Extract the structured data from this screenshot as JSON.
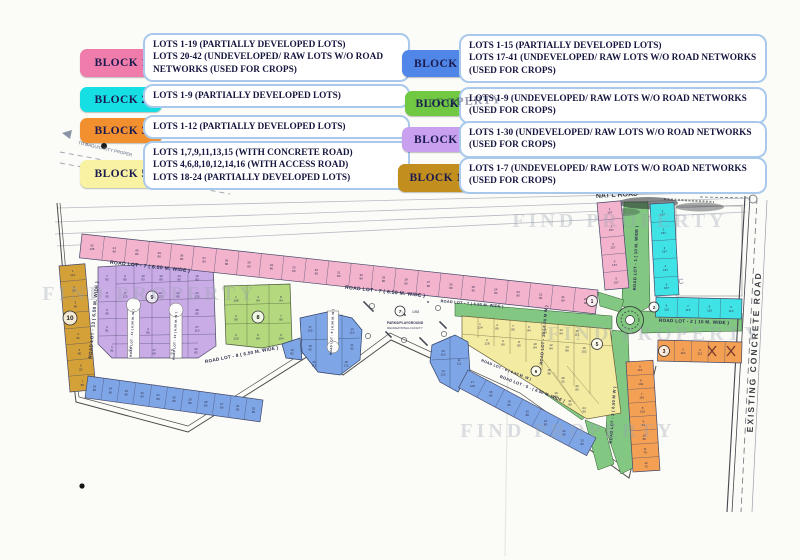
{
  "legend": {
    "left": [
      {
        "chip": "BLOCK 1",
        "chip_color": "#f07cab",
        "lines": [
          "LOTS 1-19  (PARTIALLY DEVELOPED LOTS)",
          "LOTS 20-42 (UNDEVELOPED/ RAW LOTS W/O ROAD",
          "NETWORKS (USED FOR CROPS)"
        ]
      },
      {
        "chip": "BLOCK 2",
        "chip_color": "#16dfe4",
        "lines": [
          "LOTS 1-9   (PARTIALLY DEVELOPED LOTS)"
        ]
      },
      {
        "chip": "BLOCK 3",
        "chip_color": "#f28f2e",
        "lines": [
          "LOTS 1-12  (PARTIALLY DEVELOPED LOTS)"
        ]
      },
      {
        "chip": "BLOCK 5",
        "chip_color": "#f8f2a2",
        "lines": [
          "LOTS 1,7,9,11,13,15 (WITH CONCRETE ROAD)",
          "LOTS 4,6,8,10,12,14,16 (WITH ACCESS ROAD)",
          "LOTS 18-24 (PARTIALLY DEVELOPED LOTS)"
        ]
      }
    ],
    "right": [
      {
        "chip": "BLOCK 7",
        "chip_color": "#4f86e8",
        "lines": [
          "LOTS 1-15  (PARTIALLY DEVELOPED LOTS)",
          "LOTS 17-41 (UNDEVELOPED/ RAW LOTS W/O ROAD NETWORKS",
          "(USED FOR CROPS)"
        ]
      },
      {
        "chip": "BLOCK 8",
        "chip_color": "#70c843",
        "lines": [
          "LOTS 1-9 (UNDEVELOPED/ RAW LOTS W/O ROAD NETWORKS",
          "(USED FOR CROPS)"
        ]
      },
      {
        "chip": "BLOCK 9",
        "chip_color": "#c8a0ef",
        "lines": [
          "LOTS 1-30 (UNDEVELOPED/ RAW LOTS W/O ROAD NETWORKS",
          "(USED FOR CROPS)"
        ]
      },
      {
        "chip": "BLOCK 10",
        "chip_color": "#c28f1e",
        "lines": [
          "LOTS 1-7 (UNDEVELOPED/ RAW LOTS W/O ROAD NETWORKS",
          "(USED FOR CROPS)"
        ]
      }
    ]
  },
  "map": {
    "watermark": "FIND PROPERTY",
    "watermark_dark": "PROPERTY",
    "annotations": {
      "to_proper": "TO BAGUIO CITY PROPER",
      "natl_road_top": "NAT'L ROAD",
      "natl_road_legend": "NAT'L ROAD",
      "existing_road": "EXISTING CONCRETE ROAD",
      "park_line1": "PARKS/PLAYGROUND",
      "park_line2": "RECREATIONAL FACILITY",
      "park_area": "1058",
      "nc": "N/C"
    },
    "strips": [
      {
        "name": "block1-row",
        "x1": 82,
        "y1": 234,
        "x2": 598,
        "y2": 290,
        "w": 24,
        "side": 1,
        "fill": "#f3b3cc",
        "labels": [
          "42/105",
          "41/80",
          "40/80",
          "39/80",
          "38/80",
          "37/80",
          "36/80",
          "35/80",
          "34/80",
          "33/80",
          "32/80",
          "31/80",
          "30/80",
          "29/80",
          "28/80",
          "27/80",
          "26/80",
          "25/80",
          "24/80",
          "23/80",
          "22/80",
          "21/80",
          "20/90"
        ]
      },
      {
        "name": "block1-col",
        "x1": 597,
        "y1": 203,
        "x2": 605,
        "y2": 290,
        "w": 24,
        "side": -1,
        "fill": "#f3b3cc",
        "labels": [
          "1/157",
          "2/157",
          "3/157",
          "4/157",
          "5/157"
        ]
      },
      {
        "name": "block10-col",
        "x1": 59,
        "y1": 266,
        "x2": 70,
        "y2": 392,
        "w": 26,
        "side": -1,
        "fill": "#d3a137",
        "labels": [
          "1/121",
          "2/80",
          "3/80",
          "",
          "4/81",
          "5/80",
          "6/82",
          "7/80"
        ]
      },
      {
        "name": "block2-col",
        "x1": 650,
        "y1": 204,
        "x2": 655,
        "y2": 296,
        "w": 24,
        "side": -1,
        "fill": "#3fe3e6",
        "labels": [
          "1/157",
          "2/157",
          "3/157",
          "4/157",
          "5/157"
        ]
      },
      {
        "name": "block2-row",
        "x1": 656,
        "y1": 297,
        "x2": 742,
        "y2": 299,
        "w": 20,
        "side": 1,
        "fill": "#3fe3e6",
        "labels": [
          "6/115",
          "7/115",
          "8/115",
          "9/115"
        ]
      },
      {
        "name": "block3-row",
        "x1": 658,
        "y1": 340,
        "x2": 742,
        "y2": 342,
        "w": 21,
        "side": 1,
        "fill": "#f4a054",
        "labels": [
          "1/110",
          "2/110",
          "3/112",
          "",
          ""
        ]
      },
      {
        "name": "block3-col",
        "x1": 626,
        "y1": 362,
        "x2": 633,
        "y2": 472,
        "w": 27,
        "side": -1,
        "fill": "#f4a054",
        "labels": [
          "5/112",
          "6/102",
          "7/110",
          "8/102",
          "9/81",
          "10/80",
          "11/79",
          "12/75"
        ]
      },
      {
        "name": "block7-left",
        "x1": 88,
        "y1": 376,
        "x2": 263,
        "y2": 400,
        "w": 22,
        "side": 1,
        "fill": "#7ea6e6",
        "labels": [
          "35/80",
          "34/80",
          "33/80",
          "32/80",
          "31/80",
          "30/80",
          "29/80",
          "28/80",
          "27/80",
          "26/80",
          "25/80"
        ]
      },
      {
        "name": "block7-band",
        "x1": 468,
        "y1": 370,
        "x2": 596,
        "y2": 438,
        "w": 20,
        "side": 1,
        "fill": "#7ea6e6",
        "labels": [
          "17/105",
          "18/80",
          "19/80",
          "20/80",
          "21/80",
          "22/80",
          "23/80"
        ]
      }
    ],
    "lot_labels": [
      [
        107,
        277,
        "7",
        "83"
      ],
      [
        125,
        277,
        "9",
        "85"
      ],
      [
        143,
        277,
        "10",
        "93"
      ],
      [
        161,
        277,
        "12",
        "80"
      ],
      [
        179,
        277,
        "14",
        "80"
      ],
      [
        197,
        277,
        "16",
        "83"
      ],
      [
        107,
        294,
        "8",
        "93"
      ],
      [
        125,
        294,
        "8",
        "123"
      ],
      [
        160,
        294,
        "13",
        "123"
      ],
      [
        178,
        294,
        "21",
        "85"
      ],
      [
        197,
        294,
        "23",
        "125"
      ],
      [
        107,
        311,
        "5",
        "80"
      ],
      [
        197,
        311,
        "28",
        "80"
      ],
      [
        107,
        328,
        "3",
        "81"
      ],
      [
        148,
        330,
        "4",
        "85"
      ],
      [
        197,
        328,
        "27",
        "110"
      ],
      [
        112,
        348,
        "1",
        "81"
      ],
      [
        130,
        348,
        "2",
        "93"
      ],
      [
        154,
        351,
        "17",
        "99"
      ],
      [
        172,
        351,
        "18",
        "99"
      ],
      [
        196,
        350,
        "20",
        "83"
      ],
      [
        236,
        298,
        "1",
        "108"
      ],
      [
        258,
        298,
        "4",
        "84"
      ],
      [
        281,
        298,
        "8",
        "84"
      ],
      [
        236,
        317,
        "2",
        "80"
      ],
      [
        281,
        317,
        "7",
        "80"
      ],
      [
        236,
        336,
        "3",
        "120"
      ],
      [
        258,
        336,
        "6",
        "84"
      ],
      [
        281,
        336,
        "9",
        "104"
      ],
      [
        480,
        325,
        "1",
        "124"
      ],
      [
        497,
        326,
        "4",
        "80"
      ],
      [
        513,
        327,
        "7",
        "80"
      ],
      [
        529,
        328,
        "9",
        "84"
      ],
      [
        545,
        330,
        "11",
        "84"
      ],
      [
        561,
        331,
        "13",
        "94"
      ],
      [
        577,
        332,
        "15",
        "112"
      ],
      [
        487,
        341,
        "2",
        "128"
      ],
      [
        503,
        342,
        "6",
        "80"
      ],
      [
        519,
        343,
        "8",
        "80"
      ],
      [
        535,
        345,
        "10",
        "84"
      ],
      [
        551,
        346,
        "12",
        "84"
      ],
      [
        567,
        348,
        "14",
        "80"
      ],
      [
        584,
        349,
        "16",
        "102"
      ],
      [
        549,
        371,
        "18",
        "98"
      ],
      [
        563,
        379,
        "20",
        "92"
      ],
      [
        577,
        387,
        "22",
        "80"
      ],
      [
        556,
        394,
        "19",
        "80"
      ],
      [
        570,
        402,
        "21",
        "80"
      ],
      [
        584,
        409,
        "24",
        "90"
      ],
      [
        310,
        328,
        "17",
        "105"
      ],
      [
        310,
        347,
        "18",
        "95"
      ],
      [
        314,
        363,
        "30",
        "113"
      ],
      [
        346,
        363,
        "18",
        "132"
      ],
      [
        352,
        330,
        "12",
        "116"
      ],
      [
        352,
        346,
        "21",
        "82"
      ],
      [
        292,
        351,
        "16",
        "82"
      ],
      [
        443,
        352,
        "15",
        "110"
      ],
      [
        443,
        372,
        "13",
        "132"
      ],
      [
        459,
        361,
        "11",
        "111"
      ]
    ],
    "road_labels": [
      [
        "ROAD LOT - 7  ( 6.50 M. WIDE )",
        150,
        268,
        6,
        5
      ],
      [
        "ROAD LOT - 7  ( 6.50 M. WIDE )",
        385,
        293,
        6,
        5
      ],
      [
        "ROAD LOT - 7  ( 6.50 M. WIDE )",
        472,
        305,
        5,
        3.8
      ],
      [
        "ROAD LOT - 13  ( 6.50 M. WIDE )",
        95,
        320,
        -85,
        4.6
      ],
      [
        "ROAD LOT - 1 ( 10 M. WIDE )",
        637,
        258,
        -88,
        4.2
      ],
      [
        "ROAD LOT - 10 ( 6.50 M W )",
        545,
        335,
        -85,
        4
      ],
      [
        "ROAD LOT - 2  ( 10 M. WIDE )",
        694,
        323,
        2,
        4.6
      ],
      [
        "ROAD LOT - 3 ( 6.50 M W )",
        614,
        415,
        -86,
        4
      ],
      [
        "ROAD LOT - 8  ( 6.50 M. WIDE )",
        242,
        356,
        -11,
        4.6
      ],
      [
        "ROAD LOT - 5 - ( 6.50 M. WIDE )",
        532,
        390,
        21,
        4
      ],
      [
        "ROAD LOT - 6 ( 6.50 M. W )",
        506,
        371,
        21,
        3.6
      ],
      [
        "ROAD LOT - 11 ( 6.50 M. W )",
        133,
        333,
        -87,
        3
      ],
      [
        "ROAD LOT - 12 ( 6.50 M. W )",
        176,
        336,
        -87,
        3
      ],
      [
        "ROAD LOT - 9 ( 6.50 M. W )",
        333,
        332,
        -87,
        3
      ]
    ],
    "block_circles": [
      [
        "1",
        592,
        301,
        5.5
      ],
      [
        "2",
        654,
        307,
        5
      ],
      [
        "3",
        664,
        351,
        5.5
      ],
      [
        "5",
        597,
        344,
        5.5
      ],
      [
        "6",
        536,
        371,
        5
      ],
      [
        "7",
        400,
        311,
        5
      ],
      [
        "8",
        258,
        317,
        6
      ],
      [
        "9",
        152,
        297,
        6
      ],
      [
        "10",
        70,
        318,
        7
      ]
    ],
    "x_marks": [
      [
        712,
        351
      ],
      [
        731,
        351
      ]
    ],
    "watermark_spots": [
      [
        620,
        227,
        0
      ],
      [
        655,
        340,
        0
      ],
      [
        150,
        300,
        0
      ],
      [
        568,
        437,
        0
      ]
    ]
  }
}
